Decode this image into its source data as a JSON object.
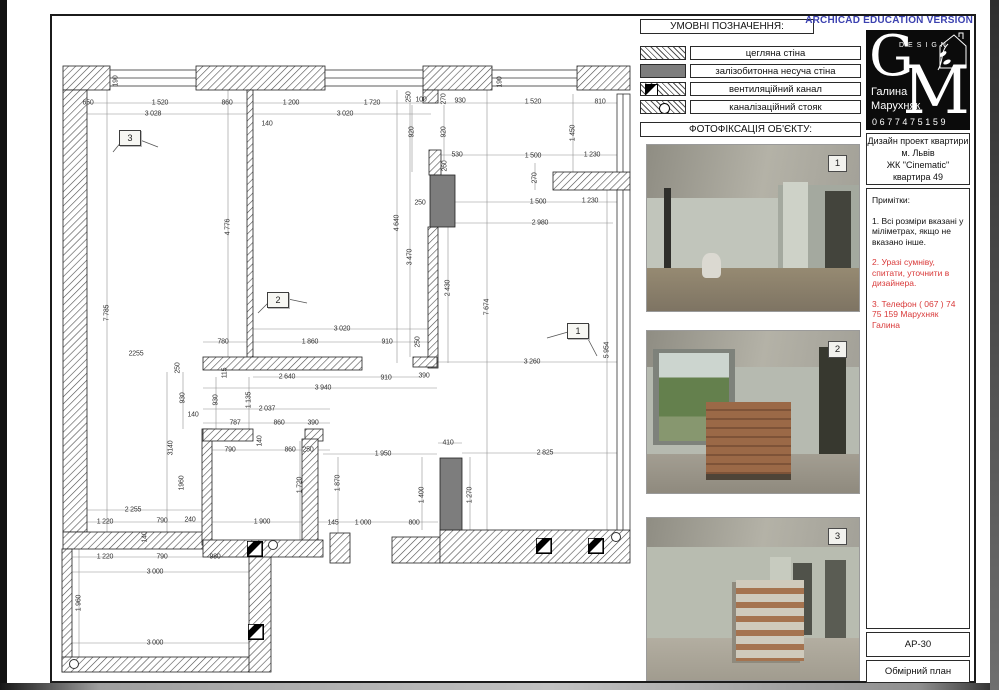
{
  "watermark": "ARCHICAD EDUCATION VERSION",
  "colors": {
    "accent_blue": "#3c42b0",
    "note_red": "#d93a3a",
    "concrete_gray": "#7d7d7d"
  },
  "legend": {
    "title": "УМОВНІ ПОЗНАЧЕННЯ:",
    "items": [
      {
        "key": "brick-wall",
        "label": "цегляна стіна"
      },
      {
        "key": "concrete-wall",
        "label": "залізобитонна несуча стіна"
      },
      {
        "key": "vent-duct",
        "label": "вентиляційний канал"
      },
      {
        "key": "sewer-riser",
        "label": "каналізаційний стояк"
      }
    ]
  },
  "photos": {
    "title": "ФОТОФІКСАЦІЯ ОБ'ЄКТУ:",
    "items": [
      {
        "marker": "1"
      },
      {
        "marker": "2"
      },
      {
        "marker": "3"
      }
    ]
  },
  "titleblock": {
    "logo": {
      "g": "G",
      "m": "M",
      "design": "DESIGN",
      "author1": "Галина",
      "author2": "Марухняк",
      "phone": "0677475159"
    },
    "project_line1": "Дизайн проект квартири",
    "project_line2": "м. Львів",
    "project_line3": "ЖК \"Cinematic\"",
    "project_line4": "квартира 49",
    "notes_title": "Примітки:",
    "note1": "1. Всі розміри вказані у міліметрах, якщо не вказано інше.",
    "note2": "2. Уразі сумніву, спитати, уточнити в дизайнера.",
    "note3": "3. Телефон ( 067 ) 74 75 159 Марухняк Галина",
    "sheet_code": "АР-30",
    "sheet_name": "Обмірний план"
  },
  "plan": {
    "markers": [
      {
        "label": "3",
        "x": 130,
        "y": 138
      },
      {
        "label": "2",
        "x": 278,
        "y": 300
      },
      {
        "label": "1",
        "x": 578,
        "y": 331
      }
    ],
    "dimensions": [
      {
        "t": "650",
        "x": 88,
        "y": 103
      },
      {
        "t": "1 520",
        "x": 160,
        "y": 103
      },
      {
        "t": "860",
        "x": 227,
        "y": 103
      },
      {
        "t": "1 200",
        "x": 291,
        "y": 103
      },
      {
        "t": "1 720",
        "x": 372,
        "y": 103
      },
      {
        "t": "930",
        "x": 460,
        "y": 101
      },
      {
        "t": "1 520",
        "x": 533,
        "y": 102
      },
      {
        "t": "810",
        "x": 600,
        "y": 102
      },
      {
        "t": "3 028",
        "x": 153,
        "y": 114
      },
      {
        "t": "3 020",
        "x": 345,
        "y": 114
      },
      {
        "t": "140",
        "x": 267,
        "y": 124
      },
      {
        "t": "190",
        "x": 116,
        "y": 81,
        "v": true
      },
      {
        "t": "190",
        "x": 500,
        "y": 82,
        "v": true
      },
      {
        "t": "250",
        "x": 409,
        "y": 97,
        "v": true
      },
      {
        "t": "100",
        "x": 421,
        "y": 100
      },
      {
        "t": "270",
        "x": 444,
        "y": 99,
        "v": true
      },
      {
        "t": "920",
        "x": 412,
        "y": 132,
        "v": true
      },
      {
        "t": "920",
        "x": 444,
        "y": 132,
        "v": true
      },
      {
        "t": "260",
        "x": 445,
        "y": 166,
        "v": true
      },
      {
        "t": "1 450",
        "x": 573,
        "y": 133,
        "v": true
      },
      {
        "t": "530",
        "x": 457,
        "y": 155
      },
      {
        "t": "1 500",
        "x": 533,
        "y": 156
      },
      {
        "t": "1 230",
        "x": 592,
        "y": 155
      },
      {
        "t": "270",
        "x": 535,
        "y": 178,
        "v": true
      },
      {
        "t": "1 500",
        "x": 538,
        "y": 202
      },
      {
        "t": "1 230",
        "x": 590,
        "y": 201
      },
      {
        "t": "250",
        "x": 420,
        "y": 203
      },
      {
        "t": "2 980",
        "x": 540,
        "y": 223
      },
      {
        "t": "4 776",
        "x": 228,
        "y": 227,
        "v": true
      },
      {
        "t": "4 640",
        "x": 397,
        "y": 223,
        "v": true
      },
      {
        "t": "3 470",
        "x": 410,
        "y": 257,
        "v": true
      },
      {
        "t": "2 430",
        "x": 448,
        "y": 288,
        "v": true
      },
      {
        "t": "7 674",
        "x": 487,
        "y": 307,
        "v": true
      },
      {
        "t": "7 785",
        "x": 107,
        "y": 313,
        "v": true
      },
      {
        "t": "5 954",
        "x": 607,
        "y": 350,
        "v": true
      },
      {
        "t": "2255",
        "x": 136,
        "y": 354
      },
      {
        "t": "780",
        "x": 223,
        "y": 342
      },
      {
        "t": "1 860",
        "x": 310,
        "y": 342
      },
      {
        "t": "910",
        "x": 387,
        "y": 342
      },
      {
        "t": "250",
        "x": 418,
        "y": 342,
        "v": true
      },
      {
        "t": "3 020",
        "x": 342,
        "y": 329
      },
      {
        "t": "2 640",
        "x": 287,
        "y": 377
      },
      {
        "t": "910",
        "x": 386,
        "y": 378
      },
      {
        "t": "390",
        "x": 424,
        "y": 376
      },
      {
        "t": "3 940",
        "x": 323,
        "y": 388
      },
      {
        "t": "3 260",
        "x": 532,
        "y": 362
      },
      {
        "t": "250",
        "x": 178,
        "y": 368,
        "v": true
      },
      {
        "t": "115",
        "x": 225,
        "y": 373,
        "v": true
      },
      {
        "t": "930",
        "x": 183,
        "y": 398,
        "v": true
      },
      {
        "t": "930",
        "x": 216,
        "y": 400,
        "v": true
      },
      {
        "t": "1 135",
        "x": 249,
        "y": 400,
        "v": true
      },
      {
        "t": "2 037",
        "x": 267,
        "y": 409
      },
      {
        "t": "140",
        "x": 193,
        "y": 415
      },
      {
        "t": "787",
        "x": 235,
        "y": 423
      },
      {
        "t": "860",
        "x": 279,
        "y": 423
      },
      {
        "t": "390",
        "x": 313,
        "y": 423
      },
      {
        "t": "140",
        "x": 260,
        "y": 441,
        "v": true
      },
      {
        "t": "790",
        "x": 230,
        "y": 450
      },
      {
        "t": "860",
        "x": 290,
        "y": 450
      },
      {
        "t": "250",
        "x": 308,
        "y": 450
      },
      {
        "t": "3140",
        "x": 171,
        "y": 448,
        "v": true
      },
      {
        "t": "1960",
        "x": 182,
        "y": 483,
        "v": true
      },
      {
        "t": "1 720",
        "x": 300,
        "y": 485,
        "v": true
      },
      {
        "t": "1 870",
        "x": 338,
        "y": 483,
        "v": true
      },
      {
        "t": "1 950",
        "x": 383,
        "y": 454
      },
      {
        "t": "410",
        "x": 448,
        "y": 443
      },
      {
        "t": "2 825",
        "x": 545,
        "y": 453
      },
      {
        "t": "1 400",
        "x": 422,
        "y": 495,
        "v": true
      },
      {
        "t": "1 270",
        "x": 470,
        "y": 495,
        "v": true
      },
      {
        "t": "2 255",
        "x": 133,
        "y": 510
      },
      {
        "t": "1 220",
        "x": 105,
        "y": 522
      },
      {
        "t": "790",
        "x": 162,
        "y": 521
      },
      {
        "t": "240",
        "x": 190,
        "y": 520
      },
      {
        "t": "1 900",
        "x": 262,
        "y": 522
      },
      {
        "t": "145",
        "x": 333,
        "y": 523
      },
      {
        "t": "1 000",
        "x": 363,
        "y": 523
      },
      {
        "t": "800",
        "x": 414,
        "y": 523
      },
      {
        "t": "140",
        "x": 145,
        "y": 537,
        "v": true
      },
      {
        "t": "1 220",
        "x": 105,
        "y": 557
      },
      {
        "t": "790",
        "x": 162,
        "y": 557
      },
      {
        "t": "980",
        "x": 215,
        "y": 557
      },
      {
        "t": "3 000",
        "x": 155,
        "y": 572
      },
      {
        "t": "1 960",
        "x": 79,
        "y": 603,
        "v": true
      },
      {
        "t": "3 000",
        "x": 155,
        "y": 643
      }
    ]
  }
}
